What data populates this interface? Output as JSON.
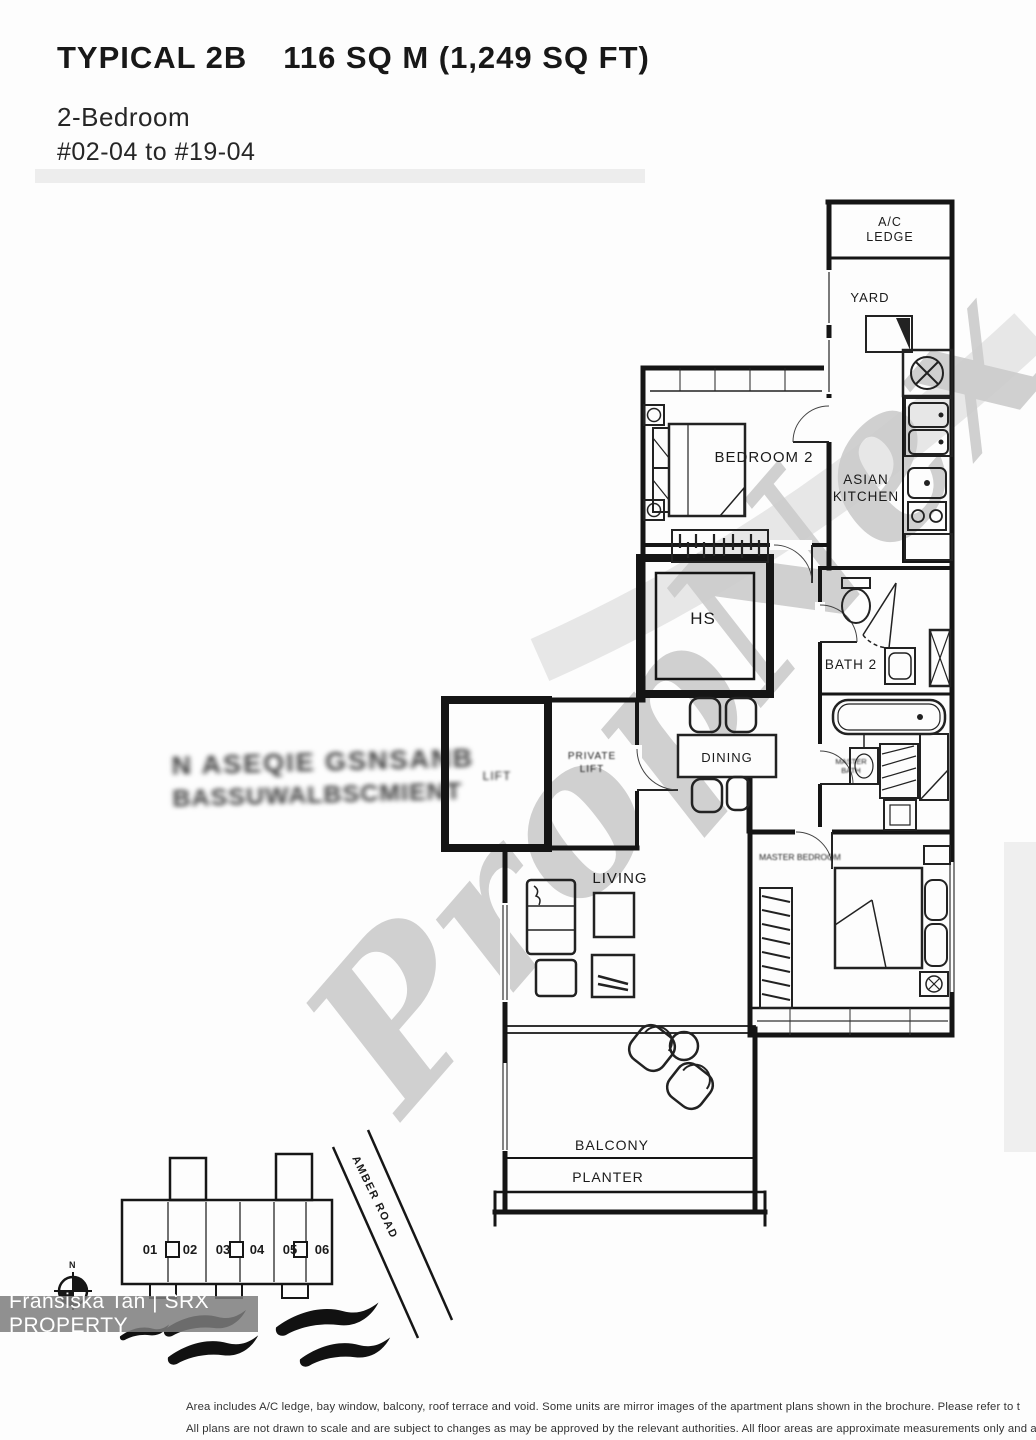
{
  "header": {
    "plan_type": "TYPICAL 2B",
    "area": "116 SQ M (1,249 SQ FT)",
    "bedroom_type": "2-Bedroom",
    "unit_range": "#02-04 to #19-04"
  },
  "watermark": {
    "text": "PropNex"
  },
  "agent_banner": {
    "text": "Fransiska Tan | SRX PROPERTY"
  },
  "stamp": {
    "line1": "N ASEQIE GSNSANB",
    "line2": "BASSUWALBSCMIENT"
  },
  "floorplan": {
    "labels": {
      "ac_ledge_1": "A/C",
      "ac_ledge_2": "LEDGE",
      "yard": "YARD",
      "bedroom2": "BEDROOM 2",
      "asian_1": "ASIAN",
      "asian_2": "KITCHEN",
      "hs": "HS",
      "bath2": "BATH 2",
      "dining": "DINING",
      "lift": "LIFT",
      "private_1": "PRIVATE",
      "private_2": "LIFT",
      "living": "LIVING",
      "master_bedroom": "MASTER BEDROOM",
      "master_bath_1": "MASTER",
      "master_bath_2": "BATH",
      "balcony": "BALCONY",
      "planter": "PLANTER"
    }
  },
  "site_plan": {
    "units": [
      "01",
      "02",
      "03",
      "04",
      "05",
      "06"
    ],
    "road": "AMBER ROAD",
    "compass_n": "N"
  },
  "disclaimer": {
    "line1": "Area includes A/C ledge, bay window, balcony, roof terrace and void. Some units are mirror images of the apartment plans shown in the brochure. Please refer to t",
    "line2": "All plans are not drawn to scale and are subject to changes as may be approved by the relevant authorities. All floor areas are approximate measurements only and ar"
  }
}
